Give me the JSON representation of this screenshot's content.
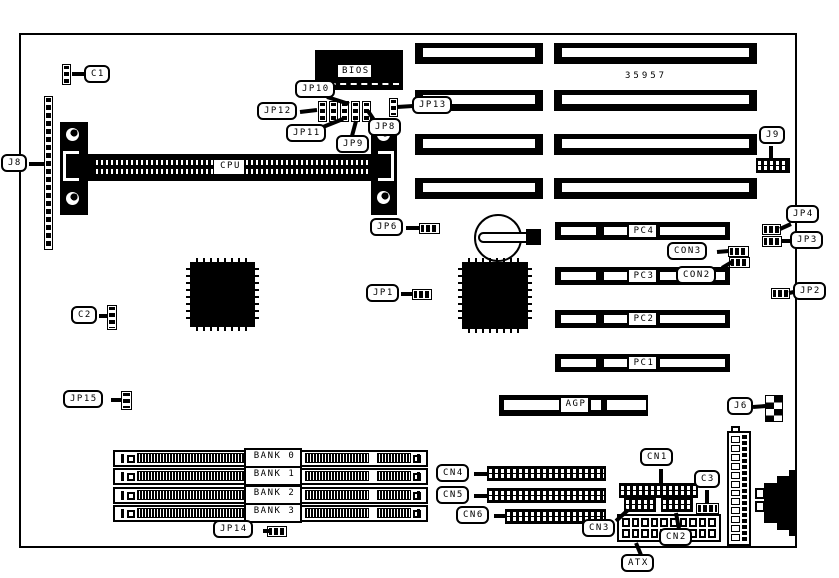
{
  "board": {
    "part_number": "35957",
    "callouts": {
      "c1": "C1",
      "j8": "J8",
      "jp10": "JP10",
      "jp12": "JP12",
      "jp11": "JP11",
      "jp9": "JP9",
      "jp8": "JP8",
      "jp13": "JP13",
      "j9": "J9",
      "jp6": "JP6",
      "jp1": "JP1",
      "jp4": "JP4",
      "jp3": "JP3",
      "jp2": "JP2",
      "con3": "CON3",
      "con2": "CON2",
      "c2": "C2",
      "jp15": "JP15",
      "jp14": "JP14",
      "j6": "J6",
      "cn4": "CN4",
      "cn5": "CN5",
      "cn6": "CN6",
      "cn1": "CN1",
      "c3": "C3",
      "cn3": "CN3",
      "cn2": "CN2",
      "atx": "ATX"
    },
    "chip_labels": {
      "bios": "BIOS",
      "cpu": "CPU",
      "agp": "AGP"
    },
    "pci_slots": [
      "PC4",
      "PC3",
      "PC2",
      "PC1"
    ],
    "memory_banks": [
      "BANK 0",
      "BANK 1",
      "BANK 2",
      "BANK 3"
    ],
    "colors": {
      "ink": "#000000",
      "paper": "#ffffff"
    }
  }
}
